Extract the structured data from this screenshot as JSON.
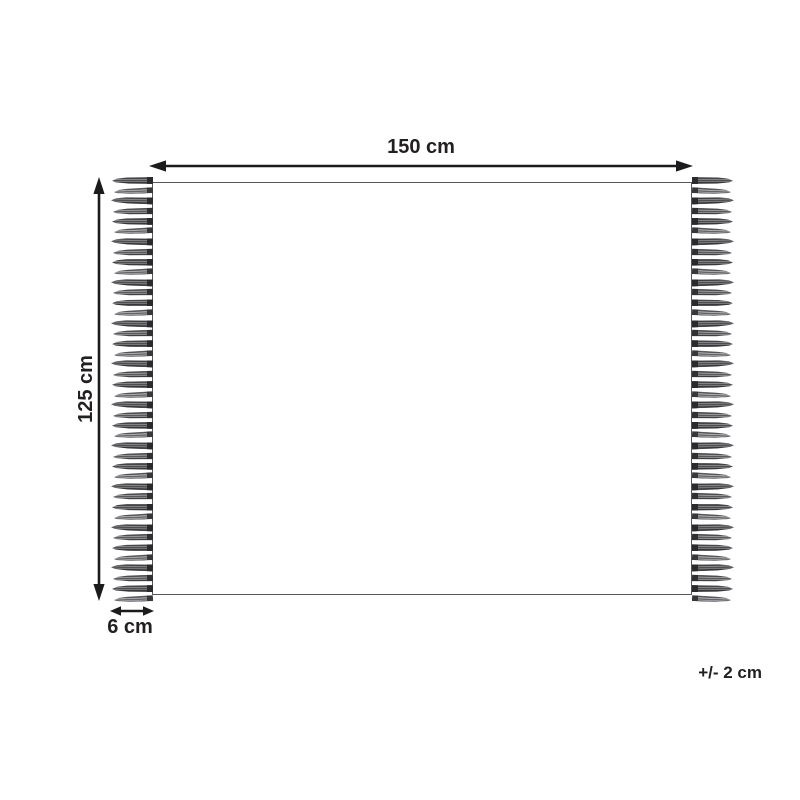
{
  "diagram": {
    "kind": "dimension-diagram",
    "labels": {
      "width": "150 cm",
      "height": "125 cm",
      "fringe": "6 cm",
      "tolerance": "+/- 2 cm"
    },
    "colors": {
      "background": "#ffffff",
      "arrow_and_text": "#231f20",
      "rug_edge": "#57575a",
      "fringe_dark": "#2c2c2e",
      "fringe_light": "#97979a"
    },
    "fringe": {
      "tassels_per_side": 42,
      "sides": [
        "left",
        "right"
      ]
    }
  }
}
